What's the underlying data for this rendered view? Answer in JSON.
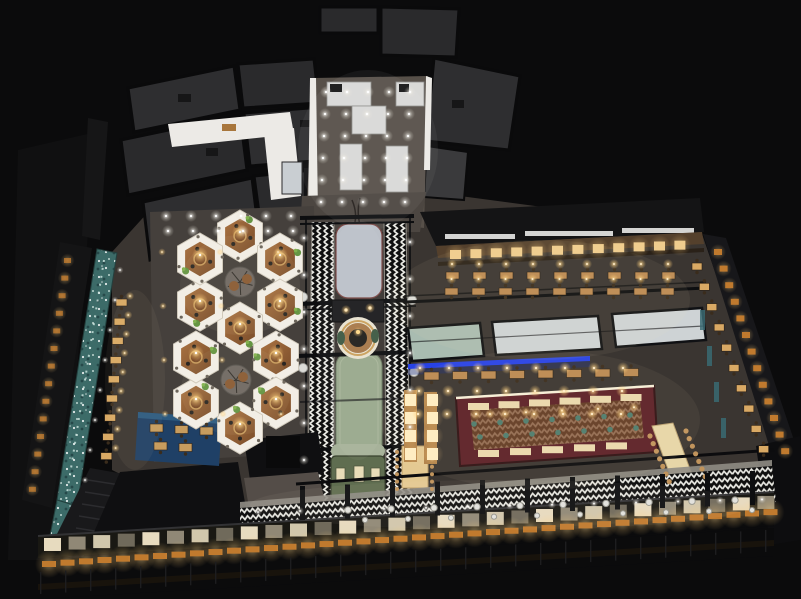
{
  "image": {
    "type": "3d-architectural-night-render",
    "subject": "aerial isometric view of a large restaurant food-hall interior",
    "visible_text": ""
  },
  "palette": {
    "background": "#0b0b0c",
    "roof_panel": "#2e2e30",
    "roof_panel_alt": "#2a2a2c",
    "roof_annex": "#3a3a3c",
    "roof_dark": "#141415",
    "floor_base": "#3a3531",
    "floor_entry": "#575049",
    "floor_corridor": "#4c4641",
    "hex_patch": "#45403c",
    "white_wall": "#eceae6",
    "kiosk_white": "#d9d9d7",
    "runner_gray": "#bcc1c9",
    "runner_green": "#9aa98d",
    "train_body": "#5f6d50",
    "train_roof": "#a7b29a",
    "train_window": "#e8dcb8",
    "hex_wall": "#f2eee6",
    "hex_floor_light": "#aa7342",
    "hex_floor_dark": "#7a4d2a",
    "hex_table": "#7a4a28",
    "plant_green": "#5d8f3a",
    "canopy_sage": "#a9bcb1",
    "canopy_gray": "#ced3d5",
    "led_blue": "#2742e6",
    "bar_red": "#5c2027",
    "bar_wood": "#7c4a2b",
    "counter_cream": "#ead9ad",
    "stool_teal": "#4e7d6e",
    "chair_wood": "#c1945c",
    "table_wood": "#bb8a52",
    "table_wood_light": "#d9a964",
    "booth_light": "#f0cd8e",
    "lamp_cream": "#ffeec2",
    "nook_table": "#c79c5e",
    "facade_pane": "#f2e6c8",
    "facade_orange": "#c07a2e",
    "glass_teal": "#3a6a72",
    "grid_line": "#1d1d1f",
    "steel_black": "#0d0e10",
    "water_teal": "#3c6b68",
    "stream_foam": "#cfe8e2",
    "nook_blue": "#1f4066",
    "stairs": "#19191b",
    "dark_mass": "#0f0f11",
    "path_gray": "#544d48",
    "concrete": "#8f8c84",
    "wall_wood": "#54402c",
    "facade_band": "#191813",
    "communal_cream": "#e7d6a8"
  },
  "geometry": {
    "hex_pavilions": {
      "radius": 26,
      "centers": [
        [
          240,
          236
        ],
        [
          280,
          259
        ],
        [
          280,
          305
        ],
        [
          240,
          328
        ],
        [
          200,
          305
        ],
        [
          200,
          259
        ],
        [
          276,
          357
        ],
        [
          276,
          403
        ],
        [
          240,
          428
        ],
        [
          196,
          403
        ],
        [
          196,
          357
        ]
      ],
      "courts": [
        [
          240,
          282
        ],
        [
          236,
          380
        ]
      ]
    },
    "strips": [
      {
        "name": "booth-lights",
        "kind": "cell",
        "x0": 450,
        "y0": 250,
        "dx": 20.4,
        "cols": 12,
        "shy": -0.85,
        "w": 11,
        "h": 9,
        "fill": "booth_light"
      },
      {
        "name": "upper-tables",
        "kind": "table",
        "x0": 446,
        "y0": 272,
        "dx": 27,
        "cols": 9,
        "rows": 2,
        "dy": 16,
        "shx": -1,
        "w": 13,
        "h": 7,
        "fill": "table_wood"
      },
      {
        "name": "mid-row-tables",
        "kind": "table",
        "x0": 424,
        "y0": 372,
        "dx": 28.5,
        "cols": 8,
        "shy": -0.5,
        "w": 15,
        "h": 8,
        "fill": "table_wood"
      },
      {
        "name": "bar-counter-top",
        "kind": "rect",
        "x0": 468,
        "y0": 403,
        "dx": 30.5,
        "cols": 6,
        "shy": -1.8,
        "w": 21,
        "h": 7,
        "fill": "counter_cream"
      },
      {
        "name": "bar-counter-bottom",
        "kind": "rect",
        "x0": 478,
        "y0": 450,
        "dx": 32,
        "cols": 5,
        "shy": -1.9,
        "w": 21,
        "h": 7,
        "fill": "counter_cream"
      },
      {
        "name": "bar-stools-front",
        "kind": "dot",
        "x0": 474,
        "y0": 424,
        "dx": 26,
        "cols": 7,
        "shy": -1.5,
        "r": 2.8,
        "fill": "stool_teal"
      },
      {
        "name": "bar-stools-back",
        "kind": "dot",
        "x0": 480,
        "y0": 437,
        "dx": 26,
        "cols": 7,
        "shy": -1.5,
        "r": 2.8,
        "fill": "stool_teal"
      },
      {
        "name": "bar-pendants",
        "kind": "light",
        "tone": "warm",
        "x0": 490,
        "y0": 414,
        "dx": 36,
        "cols": 5,
        "shy": -1.7,
        "r": 2.2
      },
      {
        "name": "communal-chairs-left",
        "kind": "dot",
        "x0": 650,
        "y0": 436,
        "dx": 3.2,
        "cols": 7,
        "shy": 7.6,
        "r": 2.6,
        "fill": "chair_wood"
      },
      {
        "name": "communal-chairs-right",
        "kind": "dot",
        "x0": 686,
        "y0": 431,
        "dx": 3.2,
        "cols": 7,
        "shy": 7.6,
        "r": 2.6,
        "fill": "chair_wood"
      },
      {
        "name": "right-wall-tables",
        "kind": "table",
        "x0": 692,
        "y0": 263,
        "dx": 7.4,
        "cols": 10,
        "shy": 20.3,
        "w": 10,
        "h": 7,
        "fill": "table_wood_light"
      },
      {
        "name": "right-wall-cells",
        "kind": "cell",
        "x0": 714,
        "y0": 249,
        "dx": 5.6,
        "cols": 13,
        "shy": 16.6,
        "w": 8,
        "h": 6,
        "fill": "facade_orange"
      },
      {
        "name": "right-wall-glass",
        "kind": "rect",
        "x0": 700,
        "y0": 310,
        "dx": 7,
        "cols": 4,
        "shy": 36,
        "w": 5,
        "h": 20,
        "fill": "glass_teal",
        "opacity": 0.85
      },
      {
        "name": "stream-tables",
        "kind": "table",
        "x0": 116,
        "y0": 299,
        "dx": -1.9,
        "cols": 9,
        "shy": 19.2,
        "w": 11,
        "h": 7,
        "fill": "table_wood_light"
      },
      {
        "name": "left-wall-cells",
        "kind": "cell",
        "x0": 64,
        "y0": 258,
        "dx": -2.7,
        "cols": 14,
        "shy": 17.6,
        "w": 7,
        "h": 5,
        "fill": "facade_orange",
        "opacity": 0.8
      },
      {
        "name": "facade-glass-panes",
        "kind": "pane",
        "x0": 44,
        "y0": 538,
        "dx": 24.6,
        "cols": 30,
        "shy": -1.45,
        "w": 17,
        "h": 13,
        "fill": "facade_pane"
      },
      {
        "name": "facade-orange-cells",
        "kind": "cell",
        "x0": 42,
        "y0": 561,
        "dx": 18.5,
        "cols": 40,
        "shy": -1.33,
        "w": 14,
        "h": 6,
        "fill": "facade_orange"
      },
      {
        "name": "facade-grid-lines",
        "kind": "vline",
        "x0": 40,
        "y0": 572,
        "dx": 25,
        "cols": 30,
        "shy": -1.45,
        "w": 1.4,
        "h": 22,
        "fill": "grid_line"
      },
      {
        "name": "promenade-posts",
        "kind": "rect",
        "x0": 300,
        "y0": 486,
        "dx": 45,
        "cols": 11,
        "shy": -1.5,
        "w": 5,
        "h": 34,
        "fill": "steel_black"
      },
      {
        "name": "promenade-stools-outer",
        "kind": "stool",
        "x0": 348,
        "y0": 510,
        "dx": 43,
        "cols": 10,
        "shy": -1.1,
        "r": 3.2
      },
      {
        "name": "promenade-stools-inner",
        "kind": "stool",
        "x0": 365,
        "y0": 520,
        "dx": 43,
        "cols": 10,
        "shy": -1.1,
        "r": 2.6
      },
      {
        "name": "train-side-chairs-left",
        "kind": "dot",
        "x0": 397,
        "y0": 452,
        "cols": 6,
        "shy": 7.4,
        "r": 2,
        "fill": "chair_wood"
      },
      {
        "name": "train-side-chairs-right",
        "kind": "dot",
        "x0": 432,
        "y0": 452,
        "cols": 6,
        "shy": 7.4,
        "r": 2,
        "fill": "chair_wood"
      },
      {
        "name": "booth-column-cells-a",
        "kind": "cell",
        "x0": 405,
        "y0": 394,
        "cols": 4,
        "shy": 18,
        "w": 11,
        "h": 12,
        "fill": "lamp_cream"
      },
      {
        "name": "booth-column-cells-b",
        "kind": "cell",
        "x0": 427,
        "y0": 394,
        "cols": 4,
        "shy": 18,
        "w": 11,
        "h": 12,
        "fill": "lamp_cream"
      },
      {
        "name": "nook-tables-top",
        "kind": "table",
        "x0": 150,
        "y0": 424,
        "dx": 25,
        "cols": 3,
        "shy": 1.5,
        "w": 13,
        "h": 8,
        "fill": "nook_table"
      },
      {
        "name": "nook-tables-bottom",
        "kind": "table",
        "x0": 154,
        "y0": 442,
        "dx": 25,
        "cols": 2,
        "shy": 1.5,
        "w": 13,
        "h": 8,
        "fill": "nook_table"
      },
      {
        "name": "entry-lights",
        "kind": "light",
        "tone": "cool",
        "x0": 326,
        "y0": 92,
        "dx": 21,
        "cols": 5,
        "rows": 6,
        "dy": 22,
        "shx": -1,
        "r": 2.6
      },
      {
        "name": "boh-corridor-lights",
        "kind": "light",
        "tone": "cool",
        "x0": 166,
        "y0": 216,
        "dx": 25,
        "cols": 6,
        "rows": 2,
        "dy": 15,
        "shx": 2,
        "r": 2.6
      },
      {
        "name": "dining-upper-lights",
        "kind": "light",
        "tone": "warm",
        "x0": 452,
        "y0": 264,
        "dx": 27,
        "cols": 9,
        "rows": 2,
        "dy": 15,
        "shx": -0.5,
        "r": 2.2
      },
      {
        "name": "dining-mid-lights",
        "kind": "light",
        "tone": "warm",
        "x0": 420,
        "y0": 368,
        "dx": 29,
        "cols": 8,
        "rows": 3,
        "dy": 23,
        "shx": -1,
        "r": 2.6
      },
      {
        "name": "walkway-lights-left",
        "kind": "light",
        "tone": "cool",
        "x0": 304,
        "y0": 238,
        "cols": 1,
        "rows": 7,
        "dy": 37,
        "r": 2.2
      },
      {
        "name": "walkway-lights-right",
        "kind": "light",
        "tone": "cool",
        "x0": 410,
        "y0": 242,
        "cols": 1,
        "rows": 6,
        "dy": 37,
        "r": 2.2
      },
      {
        "name": "stream-table-lights",
        "kind": "light",
        "tone": "warm",
        "x0": 130,
        "y0": 296,
        "cols": 1,
        "rows": 9,
        "dy": 19,
        "shx": -1.8,
        "r": 1.8
      },
      {
        "name": "stream-edge-lights",
        "kind": "light",
        "tone": "cool",
        "x0": 120,
        "y0": 270,
        "cols": 1,
        "rows": 8,
        "dy": 30,
        "shx": -5,
        "r": 1.5
      },
      {
        "name": "promenade-lights",
        "kind": "light",
        "tone": "cool",
        "x0": 258,
        "y0": 512,
        "dx": 42,
        "cols": 13,
        "shy": -1.05,
        "r": 1.8
      },
      {
        "name": "hex-area-lights",
        "kind": "light",
        "tone": "warm",
        "x0": 162,
        "y0": 252,
        "dx": 58,
        "cols": 3,
        "rows": 4,
        "dy": 54,
        "shx": 1,
        "r": 1.6
      }
    ]
  }
}
